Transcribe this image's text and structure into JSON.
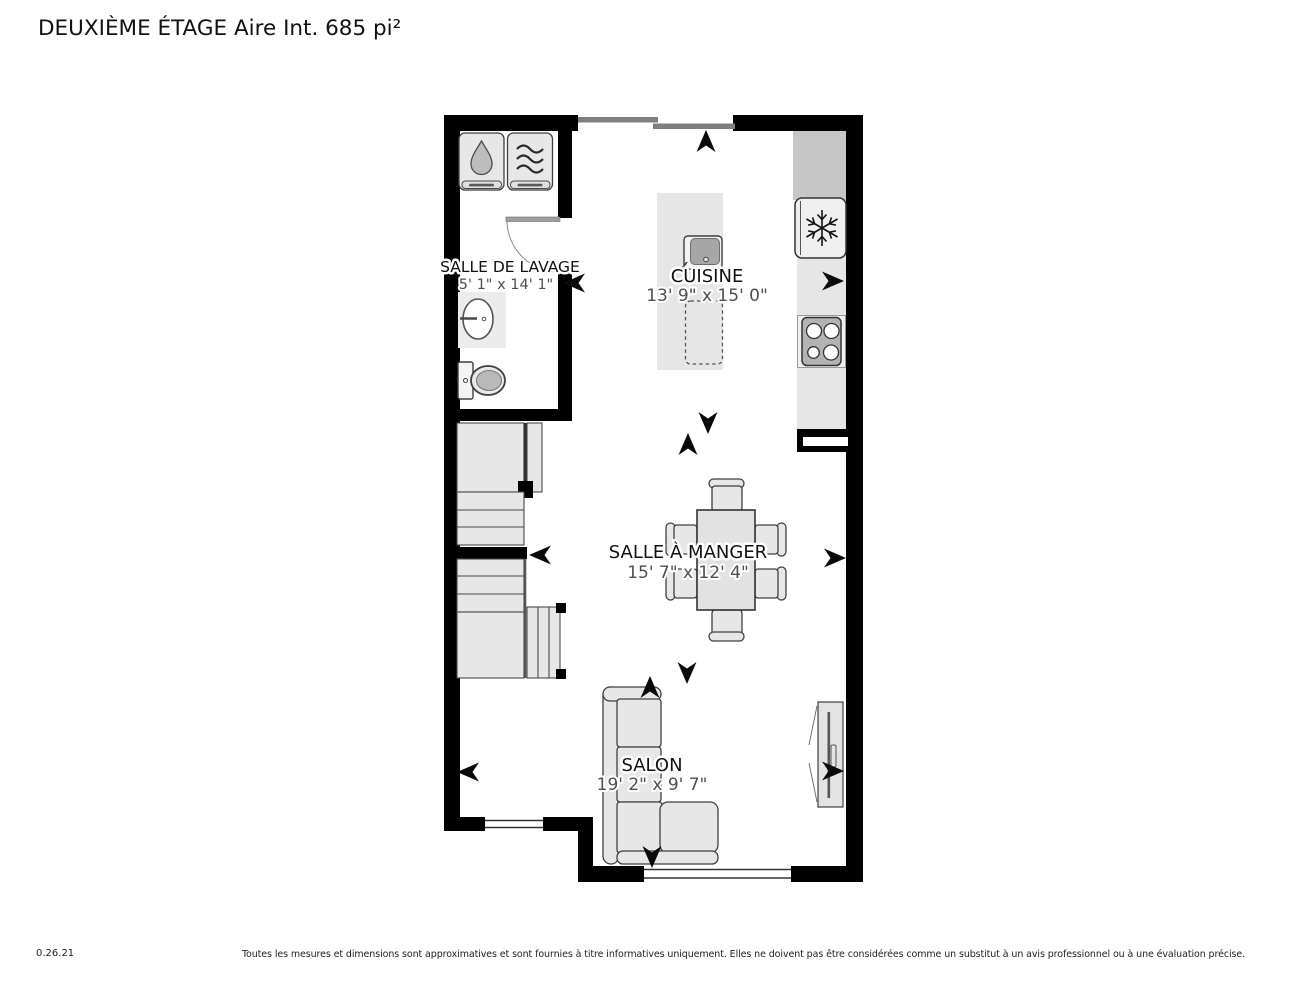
{
  "title": "DEUXIÈME ÉTAGE Aire Int. 685 pi²",
  "rooms": {
    "laundry": {
      "name": "SALLE DE LAVAGE",
      "dims": "5' 1\" x 14' 1\""
    },
    "kitchen": {
      "name": "CUISINE",
      "dims": "13' 9\" x 15' 0\""
    },
    "dining": {
      "name": "SALLE À MANGER",
      "dims": "15' 7\" x 12' 4\""
    },
    "living": {
      "name": "SALON",
      "dims": "19' 2\" x 9' 7\""
    }
  },
  "footer": {
    "version": "0.26.21",
    "disclaimer": "Toutes les mesures et dimensions sont approximatives et sont fournies à titre informatives uniquement. Elles ne doivent pas être considérées comme un substitut à un avis professionnel ou à une évaluation précise."
  },
  "colors": {
    "wall": "#000000",
    "furniture_fill": "#e7e7e7",
    "furniture_outline": "#3f3f3f",
    "counter_dark": "#c6c6c6",
    "window_gray": "#7f7f7f",
    "label_text": "#111111",
    "dimension_text": "#4f4f4f"
  }
}
